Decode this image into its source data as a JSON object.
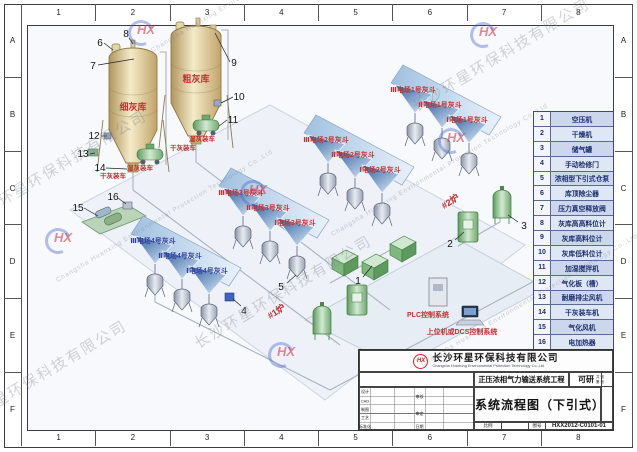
{
  "frame": {
    "columns": [
      "1",
      "2",
      "3",
      "4",
      "5",
      "6",
      "7",
      "8"
    ],
    "rows": [
      "A",
      "B",
      "C",
      "D",
      "E",
      "F"
    ]
  },
  "legend": {
    "items": [
      {
        "num": "1",
        "name": "空压机"
      },
      {
        "num": "2",
        "name": "干燥机"
      },
      {
        "num": "3",
        "name": "储气罐"
      },
      {
        "num": "4",
        "name": "手动检修门"
      },
      {
        "num": "5",
        "name": "浓相型下引式仓泵"
      },
      {
        "num": "6",
        "name": "库顶除尘器"
      },
      {
        "num": "7",
        "name": "压力真空释放阀"
      },
      {
        "num": "8",
        "name": "灰库高高料位计"
      },
      {
        "num": "9",
        "name": "灰库高料位计"
      },
      {
        "num": "10",
        "name": "灰库低料位计"
      },
      {
        "num": "11",
        "name": "加湿搅拌机"
      },
      {
        "num": "12",
        "name": "气化板（槽）"
      },
      {
        "num": "13",
        "name": "耐磨排尘风机"
      },
      {
        "num": "14",
        "name": "干灰装车机"
      },
      {
        "num": "15",
        "name": "气化风机"
      },
      {
        "num": "16",
        "name": "电加热器"
      }
    ]
  },
  "title_block": {
    "logo": "HX",
    "company_cn": "长沙环星环保科技有限公司",
    "company_en": "Changsha Huanxing Environmental Protection Technology Co.,Ltd",
    "project": "正压浓相气力输送系统工程",
    "stage": "可研",
    "sheet_total": "共 张",
    "sheet_no": "第 张",
    "drawing_title": "系统流程图（下引式）",
    "scale_label": "比例",
    "number_label": "图号",
    "drawing_number": "HXX2012-C0101-01",
    "sign_rows": [
      "设计",
      "CAD",
      "制图",
      "工艺",
      "标准化"
    ],
    "audit_labels": [
      "审核",
      "审定",
      "日期"
    ]
  },
  "diagram": {
    "fine_silo": "细灰库",
    "coarse_silo": "粗灰库",
    "dry_loading": "干灰装车",
    "wet_loading": "湿灰装车",
    "furnace_1": "#1炉",
    "furnace_2": "#2炉",
    "plc_label": "PLC控制系统",
    "dcs_label": "上位机或DCS控制系统",
    "hopper_groups": [
      {
        "labels": [
          "Ⅲ电场1号灰斗",
          "Ⅱ电场1号灰斗",
          "Ⅰ电场1号灰斗"
        ]
      },
      {
        "labels": [
          "Ⅲ电场2号灰斗",
          "Ⅱ电场2号灰斗",
          "Ⅰ电场2号灰斗"
        ]
      },
      {
        "labels": [
          "Ⅲ电场3号灰斗",
          "Ⅱ电场3号灰斗",
          "Ⅰ电场3号灰斗"
        ]
      },
      {
        "labels": [
          "Ⅲ电场4号灰斗",
          "Ⅱ电场4号灰斗",
          "Ⅰ电场4号灰斗"
        ]
      }
    ],
    "callout_numbers": [
      "1",
      "2",
      "3",
      "4",
      "5",
      "6",
      "7",
      "8",
      "9",
      "10",
      "11",
      "12",
      "13",
      "14",
      "15",
      "16"
    ]
  },
  "watermark": {
    "company_cn": "长沙环星环保科技有限公司",
    "company_en": "Changsha Huanxing Environmental Protection Technology Co.,Ltd",
    "logo": "HX"
  },
  "colors": {
    "label_red": "#c23030",
    "label_navy": "#32409d",
    "hopper_blue": "#2e5f9e",
    "equipment_green": "#7fb77f",
    "silo_tan": "#d8c48e"
  }
}
